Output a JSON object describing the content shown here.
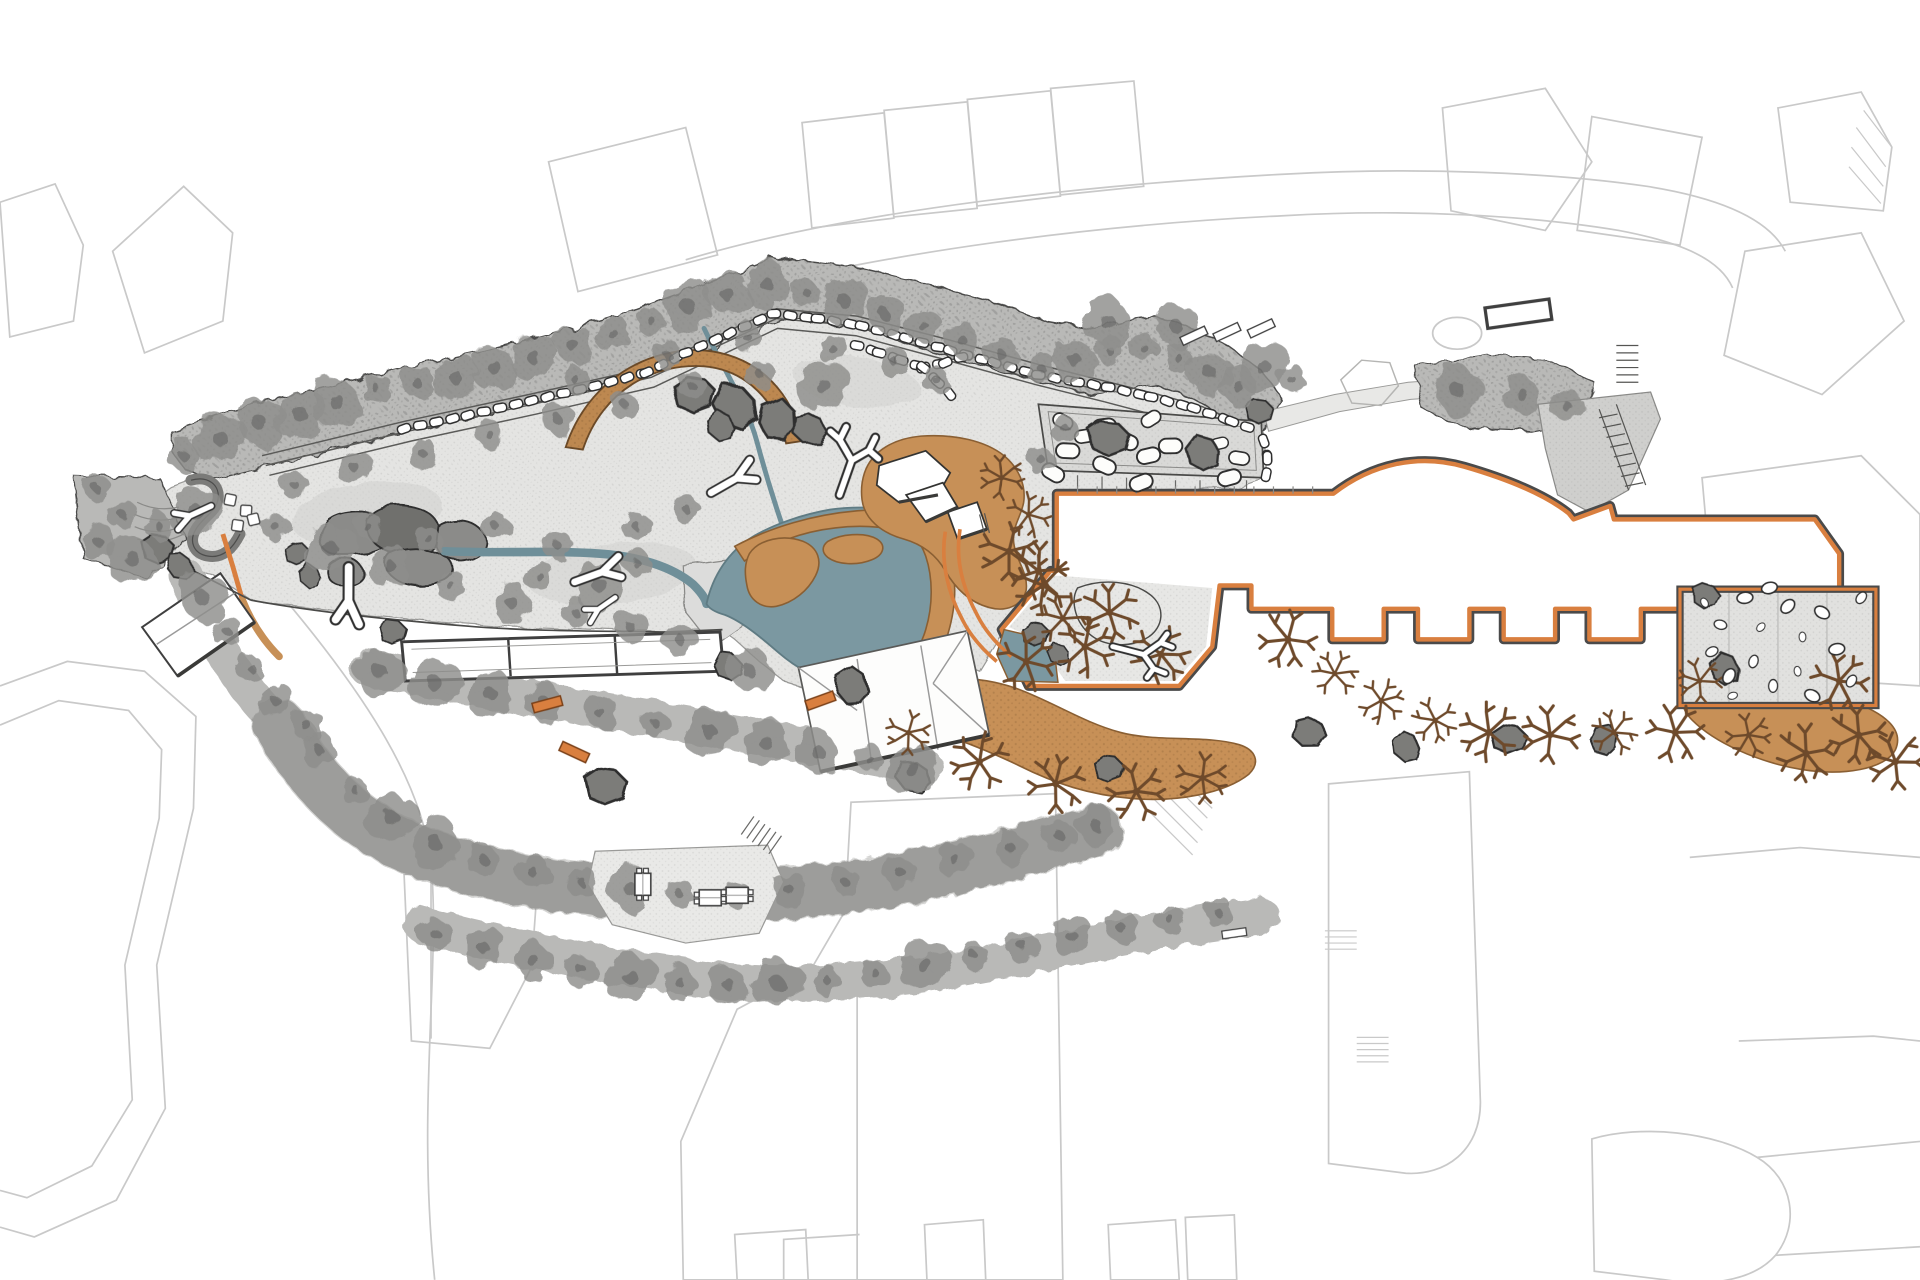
{
  "meta": {
    "document_type": "architectural landscape site plan",
    "visible_text": [],
    "description": "Plan-view rendering of an animal exhibit / park site: textured exhibit ground with pond and streams, stone perimeter wall with boulder rows, timber arc structure, white faceted-roof buildings, large visitor building outlined in orange with notched bays, boulder terrace, rock garden with white pebbles, sandy banks, rows of gray and brown trees, and light-gray context buildings around the edges."
  },
  "palette": {
    "context": "#c9c9c9",
    "contextSoft": "#dddddd",
    "outline": "#3f3f3f",
    "ground": "#e4e4e2",
    "groundEdge": "#9a9a98",
    "veg": "#b9b9b7",
    "vegDark": "#a6a6a4",
    "tree": "#8e8e8c",
    "treeDark": "#636361",
    "rock": "#7b7b79",
    "rockDark": "#2e2e2e",
    "plateau": "#8b8b89",
    "pond": "#7b98a1",
    "pondEdge": "#5f7b83",
    "stream": "#6f8f99",
    "sand": "#c79057",
    "sandEdge": "#8a5f33",
    "arc": "#bd8850",
    "accent": "#d97f3f",
    "accentDark": "#4a4a4a",
    "white": "#ffffff",
    "roofLine": "#9a9a9a",
    "brown": "#6e4a2b",
    "terrace": "#d9d9d7",
    "paving": "#cfcfcd"
  },
  "features": {
    "pond": "central slate-blue pond with tan sandy banks and island",
    "streams": "two teal streams feeding the pond",
    "arc_structure": "curved timber arc at top center",
    "stone_wall": "boulder wall rows along north perimeter path",
    "boulder_terrace": "gray terrace with scattered white boulders",
    "main_building": "large white building footprint outlined in orange with arc edge and notched bays",
    "rock_garden": "fenced garden of white pebbles at right",
    "holding_building": "long three-cell building on south fence",
    "pond_building": "white faceted-roof viewing building over pond edge",
    "ne_complex": "white shelter cluster on sand mound at pond northeast",
    "south_bands": "three curved vegetation bands with visitor path and picnic clearing"
  },
  "trees_gray": [
    [
      150,
      372
    ],
    [
      180,
      358
    ],
    [
      212,
      345
    ],
    [
      245,
      338
    ],
    [
      275,
      328
    ],
    [
      308,
      318
    ],
    [
      340,
      312
    ],
    [
      372,
      308
    ],
    [
      404,
      300
    ],
    [
      436,
      292
    ],
    [
      468,
      282
    ],
    [
      500,
      272
    ],
    [
      532,
      262
    ],
    [
      562,
      250
    ],
    [
      594,
      240
    ],
    [
      626,
      232
    ],
    [
      658,
      238
    ],
    [
      690,
      246
    ],
    [
      722,
      256
    ],
    [
      754,
      266
    ],
    [
      786,
      278
    ],
    [
      818,
      290
    ],
    [
      850,
      300
    ],
    [
      878,
      294
    ],
    [
      906,
      286
    ],
    [
      934,
      284
    ],
    [
      962,
      292
    ],
    [
      988,
      304
    ],
    [
      1012,
      316
    ],
    [
      1032,
      300
    ],
    [
      960,
      266
    ],
    [
      905,
      263
    ],
    [
      1055,
      310
    ],
    [
      240,
      395
    ],
    [
      290,
      382
    ],
    [
      345,
      370
    ],
    [
      400,
      355
    ],
    [
      455,
      342
    ],
    [
      510,
      330
    ],
    [
      565,
      315
    ],
    [
      620,
      305
    ],
    [
      672,
      315
    ],
    [
      470,
      310
    ],
    [
      545,
      290
    ],
    [
      610,
      275
    ],
    [
      680,
      285
    ],
    [
      730,
      295
    ],
    [
      765,
      310
    ],
    [
      225,
      430
    ],
    [
      270,
      448
    ],
    [
      318,
      462
    ],
    [
      368,
      478
    ],
    [
      418,
      492
    ],
    [
      300,
      430
    ],
    [
      350,
      440
    ],
    [
      405,
      430
    ],
    [
      455,
      445
    ],
    [
      440,
      470
    ],
    [
      490,
      478
    ],
    [
      520,
      460
    ],
    [
      470,
      500
    ],
    [
      515,
      512
    ],
    [
      555,
      522
    ],
    [
      160,
      418
    ],
    [
      130,
      430
    ],
    [
      612,
      548
    ],
    [
      850,
      375
    ],
    [
      870,
      350
    ],
    [
      310,
      548
    ],
    [
      355,
      558
    ],
    [
      400,
      566
    ],
    [
      445,
      574
    ],
    [
      490,
      582
    ],
    [
      535,
      590
    ],
    [
      580,
      598
    ],
    [
      625,
      606
    ],
    [
      668,
      614
    ],
    [
      710,
      620
    ],
    [
      745,
      628
    ],
    [
      165,
      488
    ],
    [
      185,
      515
    ],
    [
      205,
      545
    ],
    [
      225,
      572
    ],
    [
      250,
      592
    ],
    [
      260,
      612
    ],
    [
      290,
      645
    ],
    [
      320,
      668
    ],
    [
      355,
      688
    ],
    [
      395,
      702
    ],
    [
      435,
      712
    ],
    [
      475,
      720
    ],
    [
      515,
      726
    ],
    [
      555,
      730
    ],
    [
      600,
      730
    ],
    [
      645,
      727
    ],
    [
      690,
      720
    ],
    [
      735,
      712
    ],
    [
      780,
      702
    ],
    [
      825,
      692
    ],
    [
      865,
      682
    ],
    [
      895,
      674
    ],
    [
      355,
      762
    ],
    [
      395,
      774
    ],
    [
      435,
      784
    ],
    [
      475,
      792
    ],
    [
      515,
      798
    ],
    [
      555,
      802
    ],
    [
      595,
      804
    ],
    [
      635,
      803
    ],
    [
      675,
      800
    ],
    [
      715,
      795
    ],
    [
      755,
      788
    ],
    [
      795,
      780
    ],
    [
      835,
      772
    ],
    [
      875,
      764
    ],
    [
      915,
      757
    ],
    [
      955,
      750
    ],
    [
      995,
      745
    ],
    [
      1190,
      318
    ],
    [
      1243,
      322
    ],
    [
      1280,
      332
    ],
    [
      78,
      398
    ],
    [
      100,
      420
    ],
    [
      80,
      442
    ],
    [
      108,
      456
    ],
    [
      560,
      415
    ],
    [
      520,
      430
    ]
  ],
  "trees_brown": [
    [
      818,
      390
    ],
    [
      840,
      420
    ],
    [
      824,
      450
    ],
    [
      848,
      466
    ],
    [
      852,
      478
    ],
    [
      868,
      505
    ],
    [
      886,
      528
    ],
    [
      906,
      500
    ],
    [
      948,
      534
    ],
    [
      838,
      540
    ],
    [
      742,
      598
    ],
    [
      800,
      622
    ],
    [
      862,
      640
    ],
    [
      928,
      646
    ],
    [
      982,
      635
    ],
    [
      1052,
      522
    ],
    [
      1090,
      550
    ],
    [
      1128,
      572
    ],
    [
      1172,
      588
    ],
    [
      1216,
      598
    ],
    [
      1266,
      600
    ],
    [
      1318,
      598
    ],
    [
      1368,
      598
    ],
    [
      1428,
      600
    ],
    [
      1475,
      615
    ],
    [
      1518,
      600
    ],
    [
      1548,
      622
    ],
    [
      1502,
      556
    ],
    [
      1388,
      556
    ]
  ],
  "logs": [
    {
      "sym": "sym-log-y",
      "x": 285,
      "y": 486,
      "rot": 95,
      "s": 1.15
    },
    {
      "sym": "sym-log-y",
      "x": 488,
      "y": 468,
      "rot": -15,
      "s": 1.0
    },
    {
      "sym": "sym-log-y",
      "x": 598,
      "y": 392,
      "rot": -25,
      "s": 1.0
    },
    {
      "sym": "sym-log-branch",
      "x": 695,
      "y": 378,
      "rot": 15,
      "s": 1.15
    },
    {
      "sym": "sym-log-branch",
      "x": 932,
      "y": 534,
      "rot": 100,
      "s": 1.0
    },
    {
      "sym": "sym-log-y",
      "x": 158,
      "y": 420,
      "rot": 160,
      "s": 0.8
    },
    {
      "sym": "sym-log-y",
      "x": 491,
      "y": 496,
      "rot": 150,
      "s": 0.7
    }
  ],
  "stone_rows": [
    [
      [
        330,
        350
      ],
      [
        382,
        339
      ],
      [
        434,
        327
      ],
      [
        486,
        315
      ],
      [
        528,
        304
      ],
      [
        560,
        288
      ],
      [
        596,
        272
      ],
      [
        632,
        256
      ]
    ],
    [
      [
        632,
        256
      ],
      [
        668,
        260
      ],
      [
        704,
        266
      ],
      [
        740,
        276
      ],
      [
        776,
        286
      ],
      [
        812,
        296
      ],
      [
        848,
        306
      ],
      [
        880,
        312
      ],
      [
        905,
        316
      ]
    ],
    [
      [
        905,
        316
      ],
      [
        940,
        324
      ],
      [
        975,
        333
      ],
      [
        1006,
        344
      ],
      [
        1028,
        352
      ]
    ],
    [
      [
        1032,
        360
      ],
      [
        1035,
        374
      ],
      [
        1034,
        388
      ]
    ],
    [
      [
        700,
        282
      ],
      [
        718,
        288
      ],
      [
        736,
        294
      ],
      [
        754,
        300
      ]
    ],
    [
      [
        754,
        300
      ],
      [
        772,
        296
      ],
      [
        790,
        290
      ]
    ],
    [
      [
        754,
        300
      ],
      [
        766,
        312
      ],
      [
        778,
        324
      ]
    ]
  ],
  "boulders": [
    [
      868,
      344
    ],
    [
      886,
      356
    ],
    [
      902,
      348
    ],
    [
      872,
      368
    ],
    [
      920,
      360
    ],
    [
      938,
      372
    ],
    [
      956,
      364
    ],
    [
      978,
      372
    ],
    [
      996,
      362
    ],
    [
      1012,
      374
    ],
    [
      940,
      342
    ],
    [
      902,
      380
    ],
    [
      860,
      386
    ],
    [
      932,
      394
    ],
    [
      1004,
      390
    ]
  ],
  "pebbles": [
    [
      1392,
      492
    ],
    [
      1405,
      510
    ],
    [
      1398,
      532
    ],
    [
      1412,
      552
    ],
    [
      1425,
      488
    ],
    [
      1438,
      512
    ],
    [
      1432,
      540
    ],
    [
      1448,
      560
    ],
    [
      1460,
      495
    ],
    [
      1472,
      520
    ],
    [
      1468,
      548
    ],
    [
      1488,
      500
    ],
    [
      1500,
      530
    ],
    [
      1512,
      556
    ],
    [
      1520,
      488
    ],
    [
      1415,
      568
    ],
    [
      1480,
      568
    ],
    [
      1445,
      480
    ]
  ],
  "rocks": [
    [
      566,
      322,
      1.8,
      0
    ],
    [
      600,
      332,
      2.0,
      40
    ],
    [
      634,
      342,
      1.8,
      80
    ],
    [
      660,
      350,
      1.5,
      20
    ],
    [
      588,
      348,
      1.3,
      60
    ],
    [
      905,
      358,
      1.7,
      0
    ],
    [
      982,
      370,
      1.6,
      50
    ],
    [
      494,
      642,
      1.8,
      0
    ],
    [
      745,
      634,
      1.5,
      30
    ],
    [
      695,
      560,
      1.6,
      70
    ],
    [
      845,
      518,
      1.2,
      0
    ],
    [
      864,
      534,
      1.0,
      45
    ],
    [
      1068,
      598,
      1.5,
      20
    ],
    [
      1148,
      610,
      1.3,
      60
    ],
    [
      1232,
      604,
      1.5,
      0
    ],
    [
      1310,
      604,
      1.3,
      90
    ],
    [
      1392,
      486,
      1.2,
      10
    ],
    [
      1408,
      546,
      1.4,
      55
    ],
    [
      320,
      516,
      1.2,
      0
    ],
    [
      594,
      544,
      1.3,
      40
    ],
    [
      242,
      452,
      1.1,
      0
    ],
    [
      252,
      470,
      1.0,
      60
    ],
    [
      128,
      448,
      1.4,
      0
    ],
    [
      146,
      462,
      1.2,
      30
    ],
    [
      905,
      628,
      1.3,
      0
    ],
    [
      1028,
      336,
      1.2,
      0
    ]
  ],
  "white_squares": [
    [
      188,
      408
    ],
    [
      201,
      417
    ],
    [
      194,
      429
    ],
    [
      207,
      424
    ]
  ],
  "benches_orange": [
    [
      447,
      575,
      -15
    ],
    [
      670,
      572,
      -20
    ],
    [
      469,
      614,
      25
    ]
  ],
  "picnic_tables": [
    [
      525,
      722,
      90
    ],
    [
      580,
      733,
      0
    ],
    [
      602,
      731,
      0
    ]
  ],
  "benches_white": [
    [
      975,
      274,
      -25,
      1
    ],
    [
      1002,
      271,
      -25,
      1
    ],
    [
      1030,
      268,
      -25,
      1
    ],
    [
      1240,
      256,
      -8,
      2.4
    ],
    [
      1008,
      762,
      -8,
      0.9
    ]
  ]
}
